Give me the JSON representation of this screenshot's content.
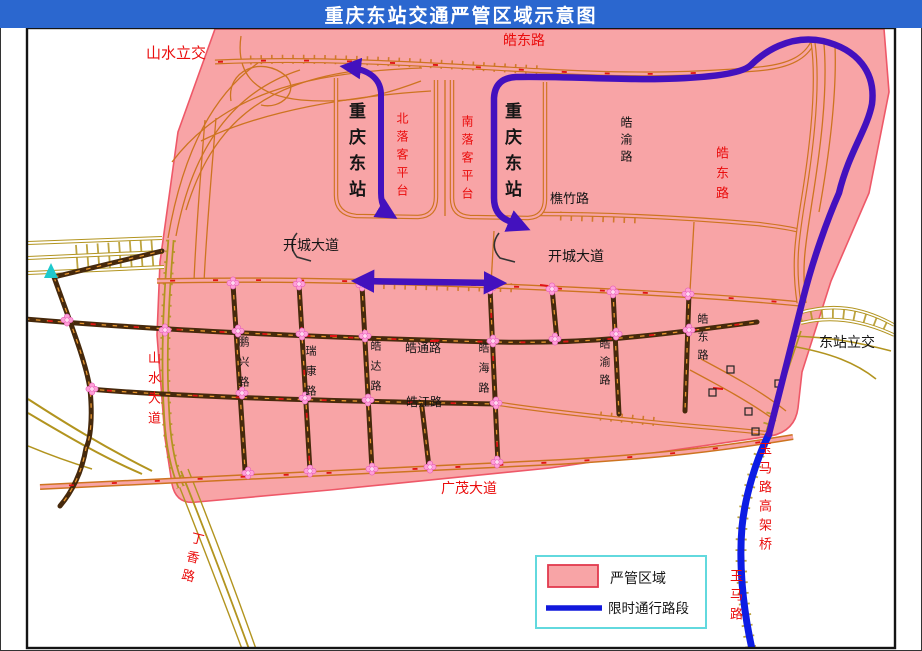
{
  "title": "重庆东站交通严管区域示意图",
  "legend": {
    "items": [
      {
        "label": "严管区域",
        "type": "area-swatch",
        "color": "#f8a4a6",
        "border": "#e13a4e"
      },
      {
        "label": "限时通行路段",
        "type": "line-swatch",
        "color": "#1118dc"
      }
    ]
  },
  "colors": {
    "title_bar": "#2b67cf",
    "zone_fill": "#f8a4a6",
    "zone_border": "#ee5868",
    "route_blue": "#4311be",
    "route_blue_bright": "#0d1de4",
    "road_orange": "#cd7420",
    "road_khaki": "#b2941f",
    "road_dark": "#46290c",
    "label_red": "#ea0d0d",
    "label_black": "#151515",
    "legend_border": "#62d9de",
    "intersection_pink": "#ff9fd8"
  },
  "map": {
    "labels": [
      {
        "text": "山水立交",
        "color": "red",
        "orientation": "h"
      },
      {
        "text": "皓东路",
        "color": "red",
        "orientation": "h"
      },
      {
        "text": "重庆东站",
        "color": "black",
        "orientation": "v"
      },
      {
        "text": "北落客平台",
        "color": "red",
        "orientation": "v"
      },
      {
        "text": "南落客平台",
        "color": "red",
        "orientation": "v"
      },
      {
        "text": "重庆东站",
        "color": "black",
        "orientation": "v"
      },
      {
        "text": "皓渝路",
        "color": "black",
        "orientation": "v"
      },
      {
        "text": "皓东路",
        "color": "red",
        "orientation": "v"
      },
      {
        "text": "樵竹路",
        "color": "black",
        "orientation": "h"
      },
      {
        "text": "开城大道",
        "color": "black",
        "orientation": "h"
      },
      {
        "text": "开城大道",
        "color": "black",
        "orientation": "h"
      },
      {
        "text": "山水大道",
        "color": "red",
        "orientation": "v"
      },
      {
        "text": "鹏兴路",
        "color": "black",
        "orientation": "v"
      },
      {
        "text": "瑞康路",
        "color": "black",
        "orientation": "v"
      },
      {
        "text": "皓达路",
        "color": "black",
        "orientation": "v"
      },
      {
        "text": "皓通路",
        "color": "black",
        "orientation": "h"
      },
      {
        "text": "皓海路",
        "color": "black",
        "orientation": "v"
      },
      {
        "text": "皓江路",
        "color": "black",
        "orientation": "h"
      },
      {
        "text": "皓渝路",
        "color": "black",
        "orientation": "v"
      },
      {
        "text": "皓东路",
        "color": "black",
        "orientation": "v"
      },
      {
        "text": "东站立交",
        "color": "black",
        "orientation": "h"
      },
      {
        "text": "广茂大道",
        "color": "red",
        "orientation": "h"
      },
      {
        "text": "丁香路",
        "color": "red",
        "orientation": "v"
      },
      {
        "text": "玉马路高架桥",
        "color": "red",
        "orientation": "v"
      },
      {
        "text": "玉马路",
        "color": "red",
        "orientation": "v"
      }
    ]
  }
}
